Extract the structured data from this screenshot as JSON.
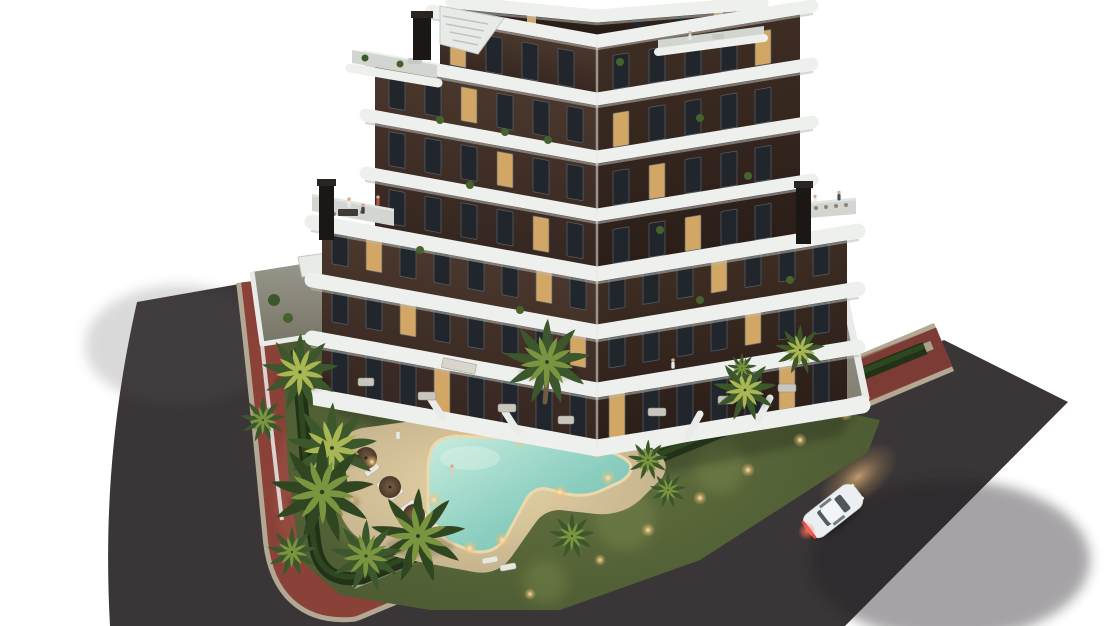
{
  "scene": {
    "type": "architectural-render",
    "description": "Dusk aerial 3D render of a modern seven-storey apartment building with curved white wrap-around balconies, landscaped garden, lit boomerang-shaped swimming pool with sun loungers and umbrellas, palm trees and hedges, a corner street with dark asphalt roads and red-brick sidewalks, and a single white car driving with headlights on. Isolated on a white background.",
    "time_of_day": "dusk",
    "background": "#ffffff"
  },
  "colors": {
    "bg": "#ffffff",
    "road": "#3a3637",
    "curb": "#b2a893",
    "sidewalk": "#8a4138",
    "sidewalk-dark": "#6e3630",
    "walkway": "#a9a28d",
    "hedge": "#223218",
    "hedge-light": "#31491f",
    "lawn-light": "#62713f",
    "lawn-dark": "#475430",
    "band": "#eef0ed",
    "band-shadow": "#b4b8b5",
    "terrace": "#d3d5d0",
    "chimney": "#1b1714",
    "wall": "#e9ebe9",
    "window": "#20262b",
    "window-lit": "#d2a765",
    "frame": "#59616a",
    "facade": "#4b382d",
    "facade-dark": "#352620",
    "facade-right": "#3e2d23",
    "facade-right-dark": "#2a1e18",
    "deck-light": "#e6d3a6",
    "deck-dark": "#baa885",
    "water-light": "#c8ecdf",
    "water-mid": "#8ccfc0",
    "water-deep": "#6fb9ab",
    "pool-rim": "#ecd9ab",
    "paving-light": "#9a978c",
    "paving-dark": "#787568",
    "trunk": "#6d5b42",
    "umbrella": "#5a4530",
    "glow": "#f0c385",
    "car": "#eceff1",
    "taillight": "#e8453c"
  },
  "building": {
    "storeys": 7,
    "penthouse": true,
    "tower_floors": 4,
    "lower_floors": 3,
    "chimneys": 3,
    "balcony_style": "curved white bands",
    "facade_material": "dark brown brick",
    "rooftop_terraces": true,
    "lit_windows": true
  },
  "pool": {
    "shape": "boomerang",
    "umbrellas": 3,
    "sun_loungers": 8,
    "underwater_lights": 7,
    "deck_material": "sand-colored stone"
  },
  "vegetation": {
    "palm_trees": 14,
    "hedge_perimeter": true,
    "lawn": true,
    "planted_island": true
  },
  "street": {
    "corner_layout": true,
    "roads": 2,
    "sidewalk_material": "red brick",
    "garden_lights": 10
  },
  "vehicles": {
    "cars": 1,
    "car_color": "white",
    "headlights_on": true,
    "taillights_on": true
  },
  "people_visible": 9
}
